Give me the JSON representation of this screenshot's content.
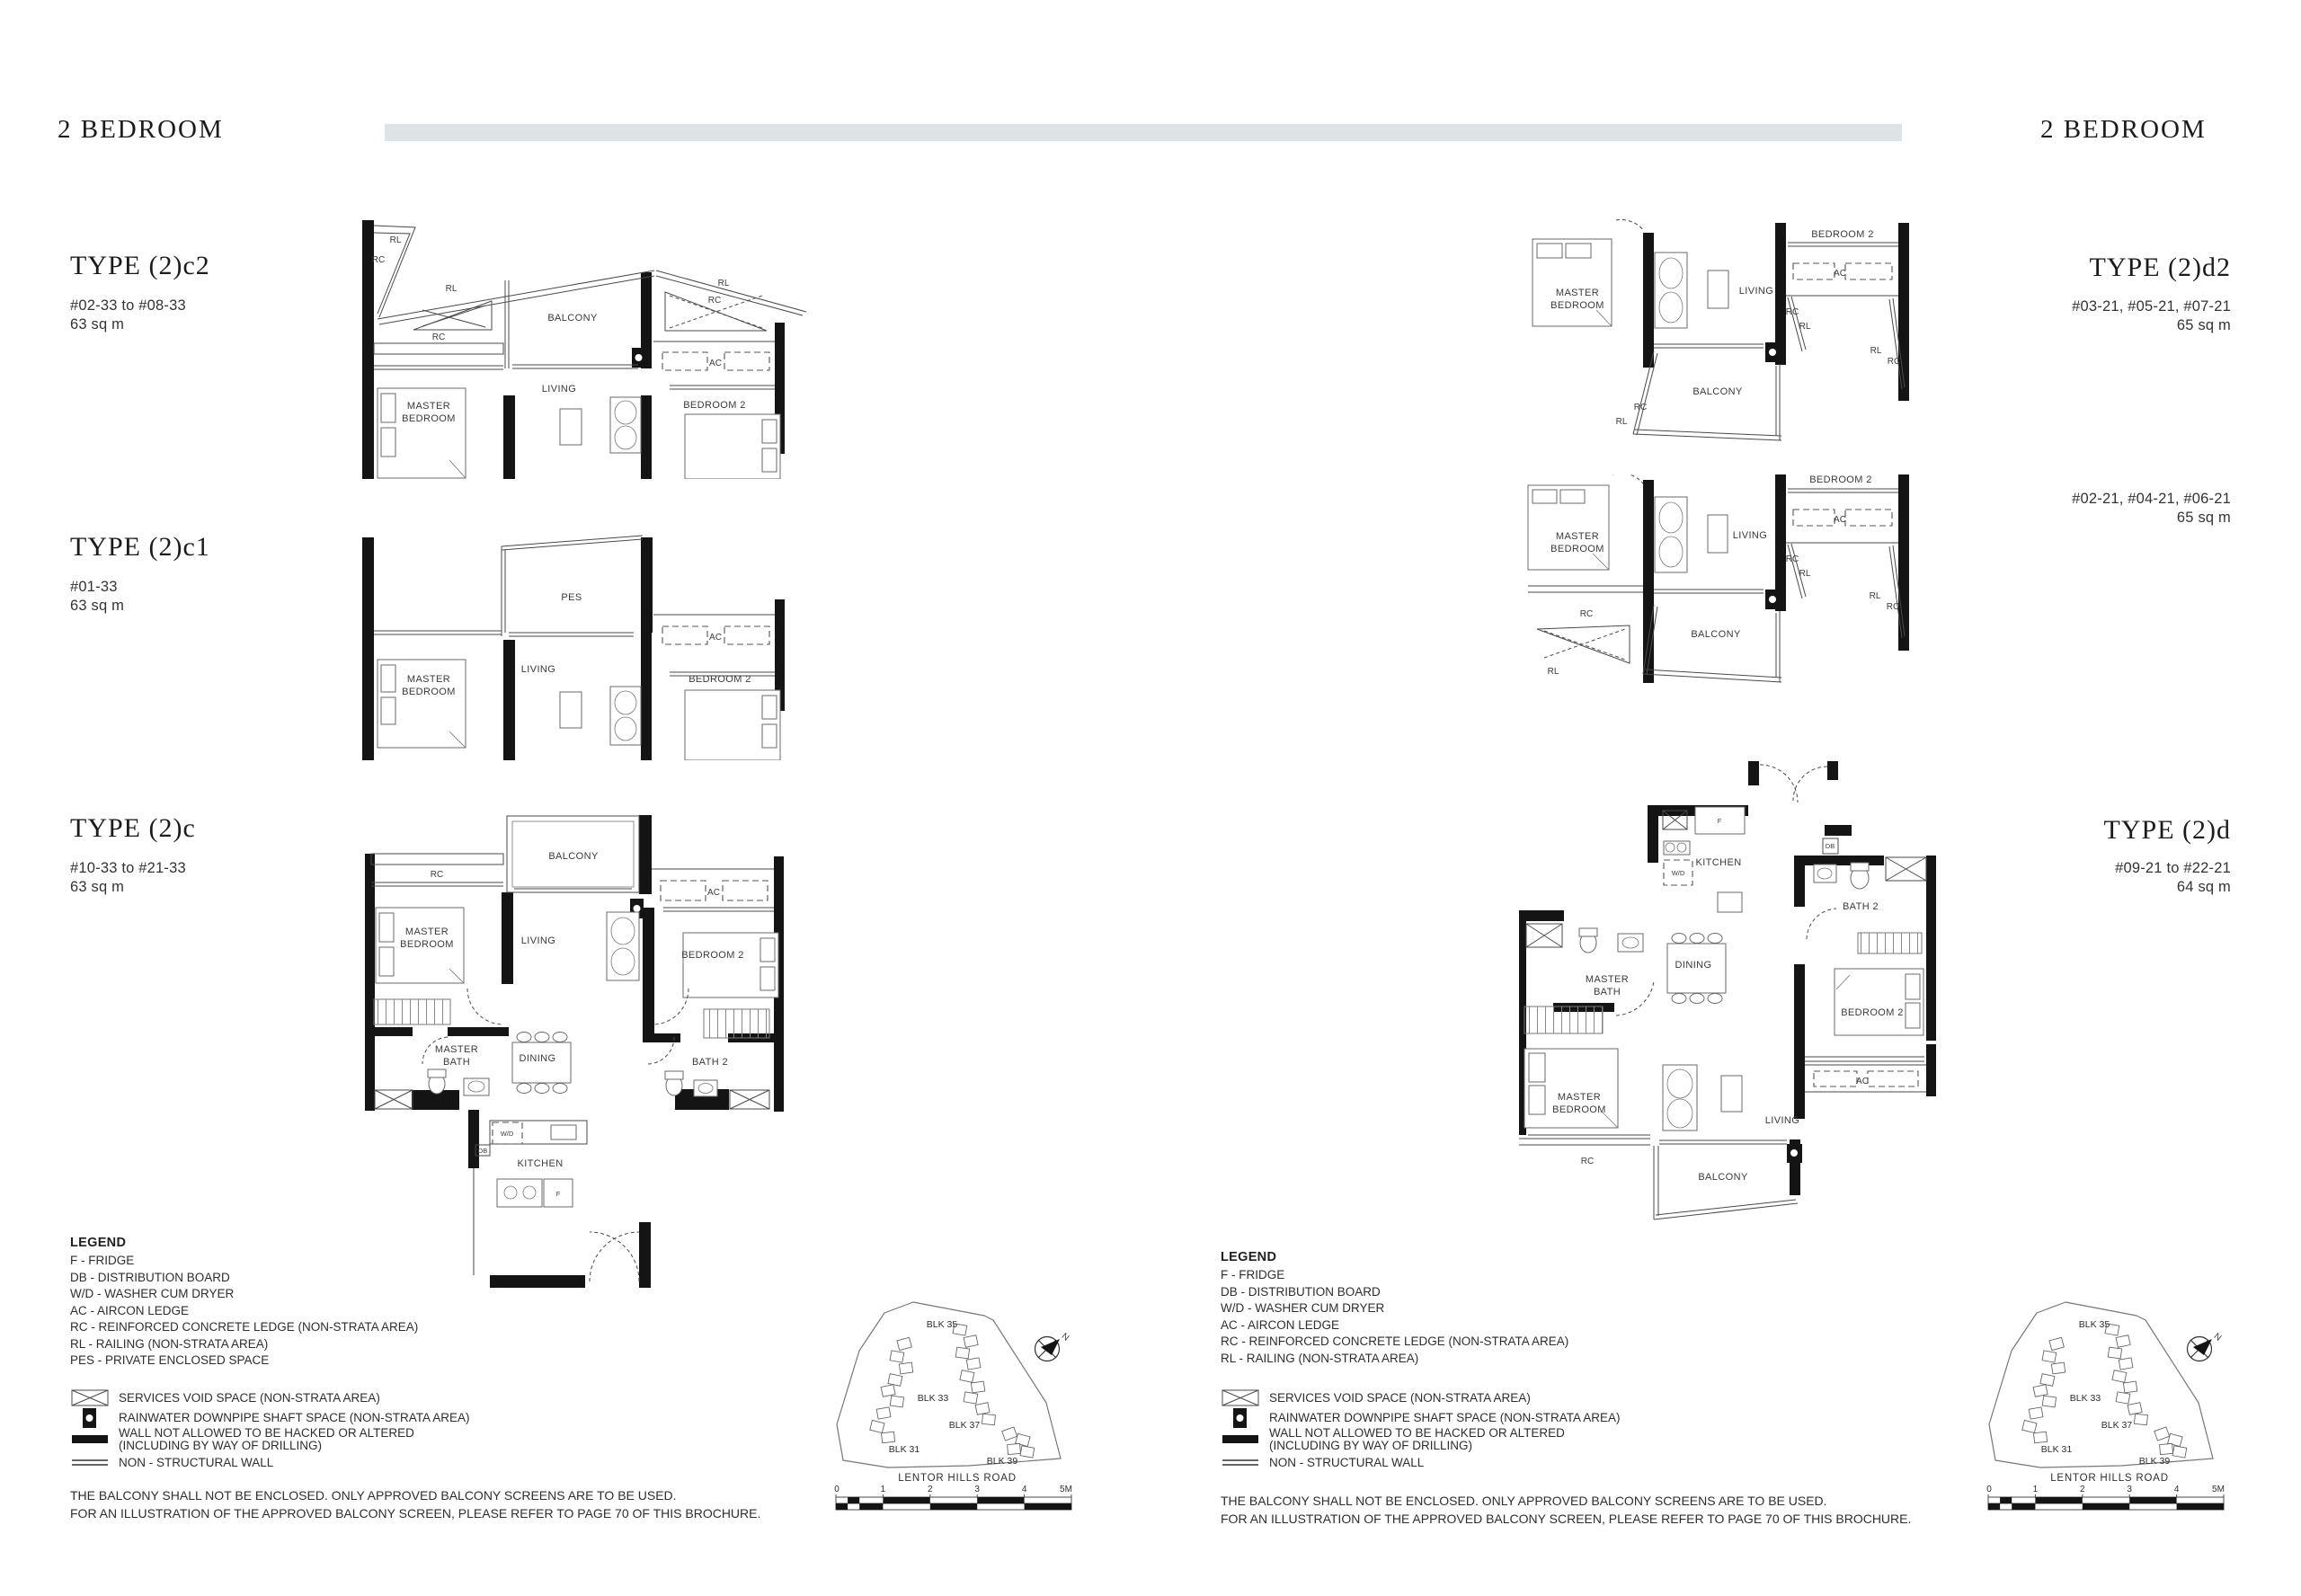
{
  "page": {
    "header_left": "2 BEDROOM",
    "header_right": "2 BEDROOM",
    "accent_bar_color": "#dde4e8"
  },
  "types": {
    "c2": {
      "title": "TYPE (2)c2",
      "units": "#02-33 to #08-33",
      "area": "63 sq m"
    },
    "c1": {
      "title": "TYPE (2)c1",
      "units": "#01-33",
      "area": "63 sq m"
    },
    "c": {
      "title": "TYPE (2)c",
      "units": "#10-33 to #21-33",
      "area": "63 sq m"
    },
    "d2": {
      "title": "TYPE (2)d2",
      "units_upper": "#03-21, #05-21, #07-21",
      "area_upper": "65 sq m",
      "units_lower": "#02-21, #04-21, #06-21",
      "area_lower": "65 sq m"
    },
    "d": {
      "title": "TYPE (2)d",
      "units": "#09-21 to #22-21",
      "area": "64 sq m"
    }
  },
  "rooms": {
    "master_l1": "MASTER",
    "master_l2": "BEDROOM",
    "mbath_l1": "MASTER",
    "mbath_l2": "BATH",
    "bedroom2": "BEDROOM 2",
    "living": "LIVING",
    "dining": "DINING",
    "kitchen": "KITCHEN",
    "balcony": "BALCONY",
    "bath2": "BATH 2",
    "pes": "PES",
    "rc": "RC",
    "rl": "RL",
    "ac": "AC",
    "f": "F",
    "db": "DB",
    "wd": "W/D"
  },
  "legend_left": {
    "title": "LEGEND",
    "abbreviations": [
      "F - FRIDGE",
      "DB - DISTRIBUTION BOARD",
      "W/D - WASHER CUM DRYER",
      "AC - AIRCON LEDGE",
      "RC - REINFORCED CONCRETE LEDGE (NON-STRATA AREA)",
      "RL - RAILING (NON-STRATA AREA)",
      "PES - PRIVATE ENCLOSED SPACE"
    ],
    "symbols": [
      {
        "label": "SERVICES VOID SPACE (NON-STRATA AREA)"
      },
      {
        "label": "RAINWATER DOWNPIPE SHAFT SPACE (NON-STRATA AREA)"
      },
      {
        "label": "WALL NOT ALLOWED TO BE HACKED OR ALTERED",
        "label2": "(INCLUDING BY WAY OF DRILLING)"
      },
      {
        "label": "NON - STRUCTURAL WALL"
      }
    ]
  },
  "legend_right": {
    "title": "LEGEND",
    "abbreviations": [
      "F - FRIDGE",
      "DB - DISTRIBUTION BOARD",
      "W/D - WASHER CUM DRYER",
      "AC - AIRCON LEDGE",
      "RC - REINFORCED CONCRETE LEDGE (NON-STRATA AREA)",
      "RL - RAILING (NON-STRATA AREA)"
    ],
    "symbols": [
      {
        "label": "SERVICES VOID SPACE (NON-STRATA AREA)"
      },
      {
        "label": "RAINWATER DOWNPIPE SHAFT SPACE (NON-STRATA AREA)"
      },
      {
        "label": "WALL NOT ALLOWED TO BE HACKED OR ALTERED",
        "label2": "(INCLUDING BY WAY OF DRILLING)"
      },
      {
        "label": "NON - STRUCTURAL WALL"
      }
    ]
  },
  "disclaimer": {
    "line1": "THE BALCONY SHALL NOT BE ENCLOSED. ONLY APPROVED BALCONY SCREENS ARE TO BE USED.",
    "line2": "FOR AN ILLUSTRATION OF THE APPROVED BALCONY SCREEN, PLEASE REFER TO PAGE 70 OF THIS BROCHURE."
  },
  "site_plan": {
    "blocks": [
      "BLK 35",
      "BLK 33",
      "BLK 37",
      "BLK 31",
      "BLK 39"
    ],
    "road": "LENTOR HILLS ROAD",
    "north": "N",
    "scale": [
      "0",
      "1",
      "2",
      "3",
      "4",
      "5M"
    ]
  }
}
